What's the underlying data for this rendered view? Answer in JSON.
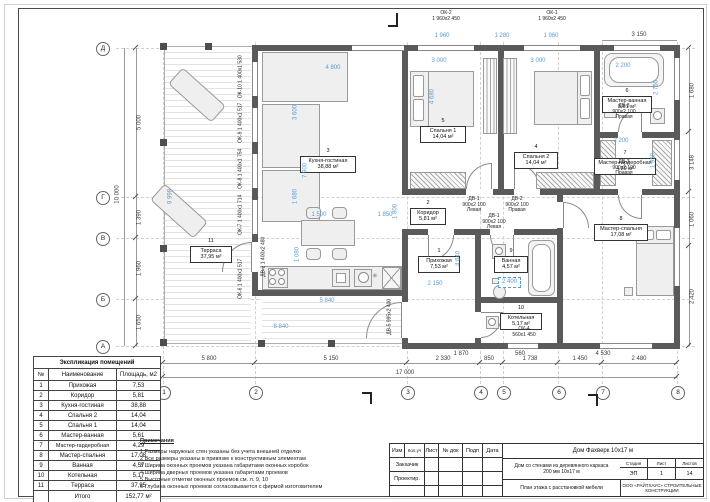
{
  "expl": {
    "title": "Экспликация помещений",
    "headers": [
      "№",
      "Наименование",
      "Площадь, м2"
    ],
    "rows": [
      [
        "1",
        "Прихожая",
        "7,53"
      ],
      [
        "2",
        "Коридор",
        "5,81"
      ],
      [
        "3",
        "Кухня-гостиная",
        "38,88"
      ],
      [
        "4",
        "Спальня 2",
        "14,04"
      ],
      [
        "5",
        "Спальня 1",
        "14,04"
      ],
      [
        "6",
        "Мастер-ванная",
        "5,61"
      ],
      [
        "7",
        "Мастер-гардеробная",
        "4,29"
      ],
      [
        "8",
        "Мастер-спальня",
        "17,08"
      ],
      [
        "9",
        "Ванная",
        "4,57"
      ],
      [
        "10",
        "Котельная",
        "5,17"
      ],
      [
        "11",
        "Терраса",
        "37,95"
      ]
    ],
    "total_label": "Итого",
    "total_value": "152,77 м²"
  },
  "notes": {
    "title": "Примечания",
    "items": [
      "1 Размеры наружных стен указаны без учета внешней отделки",
      "2 Все размеры указаны в привязке к конструктивным элементам",
      "3 Ширина оконных проемов указана габаритами оконных коробок",
      "4 Ширина дверных проемов указана габаритами проемов",
      "5 Высотные отметки оконных проемов см. л. 9, 10",
      "6 Глубина оконных проемов согласовывается с фирмой изготовителем"
    ]
  },
  "tb": {
    "cols": [
      "Изм",
      "Кол.уч",
      "Лист",
      "№ док",
      "Подп",
      "Дата"
    ],
    "row1": "Заказчик",
    "row2": "Проектир.",
    "project": "Дом Фахверк 10х17 м",
    "doc1": "Дом со стенами из деревянного каркаса",
    "doc2": "200 мм 10х17 м",
    "stage_l": "Стадия",
    "sheet_l": "Лист",
    "sheets_l": "Листов",
    "stage": "ЭП",
    "sheet": "1",
    "sheets": "14",
    "name": "План этажа с расстановкой мебели",
    "org1": "ООО «РАЙТХАУС» СТРОИТЕЛЬНЫЕ",
    "org2": "КОНСТРУКЦИИ"
  },
  "plan": {
    "axes": {
      "bottom": [
        "1",
        "2",
        "3",
        "4",
        "5",
        "6",
        "7",
        "8"
      ],
      "left": [
        "Д",
        "Г",
        "В",
        "Б",
        "А"
      ]
    },
    "rooms": [
      {
        "num": "1",
        "name": "Прихожая",
        "area_m2": "7,53 м²"
      },
      {
        "num": "2",
        "name": "Коридор",
        "area_m2": "5,81 м²"
      },
      {
        "num": "3",
        "name": "Кухня-гостиная",
        "area_m2": "38,88 м²"
      },
      {
        "num": "4",
        "name": "Спальня 2",
        "area_m2": "14,04 м²"
      },
      {
        "num": "5",
        "name": "Спальня 1",
        "area_m2": "14,04 м²"
      },
      {
        "num": "6",
        "name": "Мастер-ванная",
        "area_m2": "5,61 м²"
      },
      {
        "num": "7",
        "name": "Мастер-гардеробная",
        "area_m2": "4,29 м²"
      },
      {
        "num": "8",
        "name": "Мастер-спальня",
        "area_m2": "17,08 м²"
      },
      {
        "num": "9",
        "name": "Ванная",
        "area_m2": "4,57 м²"
      },
      {
        "num": "10",
        "name": "Котельная",
        "area_m2": "5,17 м²"
      },
      {
        "num": "11",
        "name": "Терраса",
        "area_m2": "37,95 м²"
      }
    ],
    "dims": {
      "bottom": [
        "5 800",
        "5 150",
        "2 330",
        "850",
        "1 738",
        "1 450",
        "2 480"
      ],
      "bottom_total": "17 000",
      "bottom_sub": [
        "1 870",
        "560",
        "4 530"
      ],
      "left": [
        "5 000",
        "1 390",
        "1 960",
        "1 650"
      ],
      "left_total": "10 000",
      "right": [
        "1 680",
        "3 148",
        "1 060",
        "2 420"
      ],
      "right_top": "3 150",
      "top": [
        "1 960",
        "1 280",
        "1 960"
      ],
      "blue": [
        "4 800",
        "3 600",
        "7 900",
        "1 680",
        "1 500",
        "1 850",
        "1 080",
        "5 840",
        "8 840",
        "3 000",
        "4 680",
        "3 000",
        "2 200",
        "2 750",
        "2 200",
        "1 950",
        "1 800",
        "2 150",
        "4 640",
        "9 998"
      ],
      "selected": "2 400"
    },
    "wtags": [
      {
        "t": "ОК-2",
        "s": "1 960х2 450"
      },
      {
        "t": "ОК-1",
        "s": "1 960х2 450"
      },
      {
        "t": "ОК-10",
        "s": "1 400х1 530"
      },
      {
        "t": "ОК-9",
        "s": "1 400х1 517"
      },
      {
        "t": "ОК-8",
        "s": "1 400х1 754"
      },
      {
        "t": "ОК-7",
        "s": "1 400х1 714"
      },
      {
        "t": "ОК-6",
        "s": "1 400х1 517"
      },
      {
        "t": "ОК-4",
        "s": "560х1 450"
      }
    ],
    "dtags": [
      {
        "t": "ДВ-1",
        "s": "900х2 100",
        "h": "Левая"
      },
      {
        "t": "ДВ-2",
        "s": "900х2 100",
        "h": "Правая"
      },
      {
        "t": "ДВ-1",
        "s": "900х2 100",
        "h": "Левая"
      },
      {
        "t": "ДВ-3",
        "s": "900х2 100",
        "h": "Правая"
      },
      {
        "t": "ДВ-3",
        "s": "900х2 100",
        "h": "Правая"
      },
      {
        "t": "ДВ-5",
        "s": "995х2 400",
        "h": ""
      },
      {
        "t": "ДВ-2",
        "s": "1 400х2 480",
        "h": ""
      }
    ],
    "sym": "✳",
    "colors": {
      "wall": "#5a5a5a",
      "dim_blue": "#5b9bd5",
      "furniture": "#efefef"
    }
  }
}
